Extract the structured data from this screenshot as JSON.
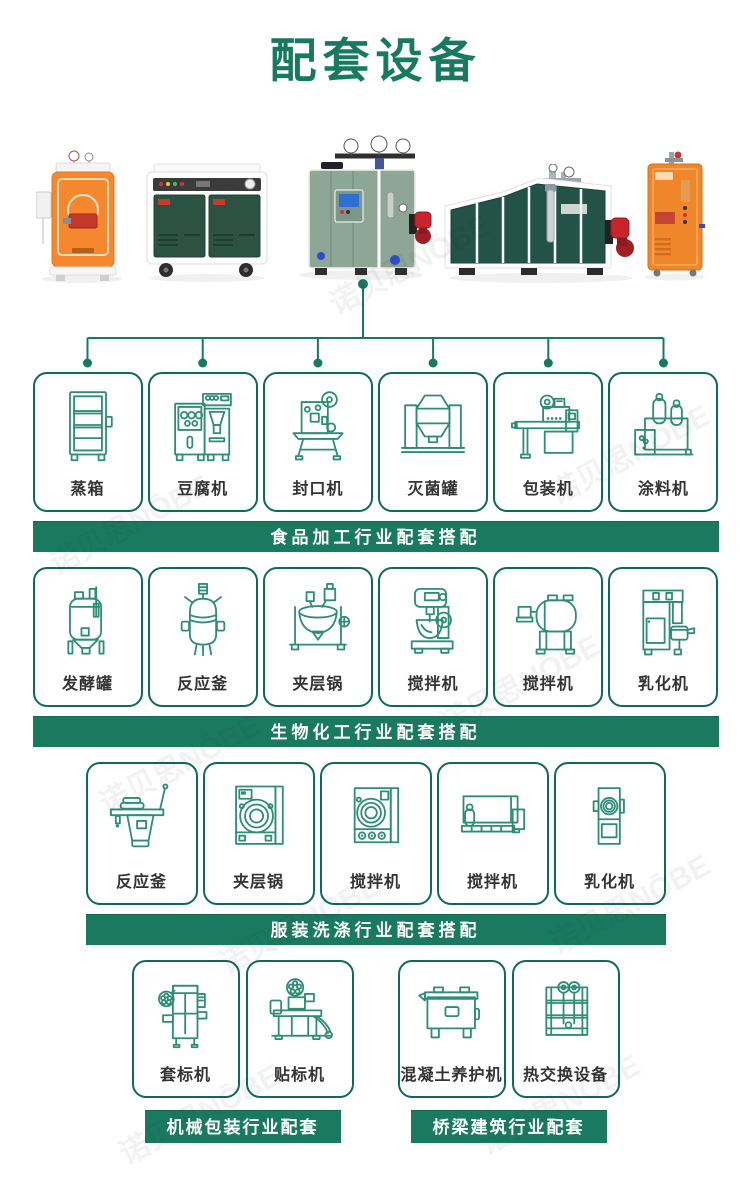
{
  "page": {
    "title": "配套设备"
  },
  "colors": {
    "accent": "#17795e",
    "banner_bg": "#1a7a60",
    "box_border": "#0e6b54",
    "icon_stroke": "#2e8d75",
    "label_text": "#333333"
  },
  "watermark": {
    "text": "诺贝思NŌBE"
  },
  "sections": [
    {
      "banner": "食品加工行业配套搭配",
      "items": [
        {
          "label": "蒸箱",
          "icon": "steam-cabinet"
        },
        {
          "label": "豆腐机",
          "icon": "tofu-machine"
        },
        {
          "label": "封口机",
          "icon": "sealing-machine"
        },
        {
          "label": "灭菌罐",
          "icon": "sterilizer-tank"
        },
        {
          "label": "包装机",
          "icon": "packing-machine"
        },
        {
          "label": "涂料机",
          "icon": "coating-machine"
        }
      ]
    },
    {
      "banner": "生物化工行业配套搭配",
      "items": [
        {
          "label": "发酵罐",
          "icon": "fermentation-tank"
        },
        {
          "label": "反应釜",
          "icon": "reaction-kettle"
        },
        {
          "label": "夹层锅",
          "icon": "jacketed-kettle"
        },
        {
          "label": "搅拌机",
          "icon": "planetary-mixer"
        },
        {
          "label": "搅拌机",
          "icon": "drum-mixer"
        },
        {
          "label": "乳化机",
          "icon": "emulsifier"
        }
      ]
    },
    {
      "banner": "服装洗涤行业配套搭配",
      "items": [
        {
          "label": "反应釜",
          "icon": "ironing-table"
        },
        {
          "label": "夹层锅",
          "icon": "washer"
        },
        {
          "label": "搅拌机",
          "icon": "dryer"
        },
        {
          "label": "搅拌机",
          "icon": "flatwork-ironer"
        },
        {
          "label": "乳化机",
          "icon": "narrow-dryer"
        }
      ]
    },
    {
      "banner": "机械包装行业配套",
      "items": [
        {
          "label": "套标机",
          "icon": "sleeve-labeler"
        },
        {
          "label": "贴标机",
          "icon": "labeling-machine"
        }
      ]
    },
    {
      "banner": "桥梁建筑行业配套",
      "items": [
        {
          "label": "混凝土养护机",
          "icon": "concrete-curing-machine"
        },
        {
          "label": "热交换设备",
          "icon": "heat-exchanger"
        }
      ]
    }
  ]
}
